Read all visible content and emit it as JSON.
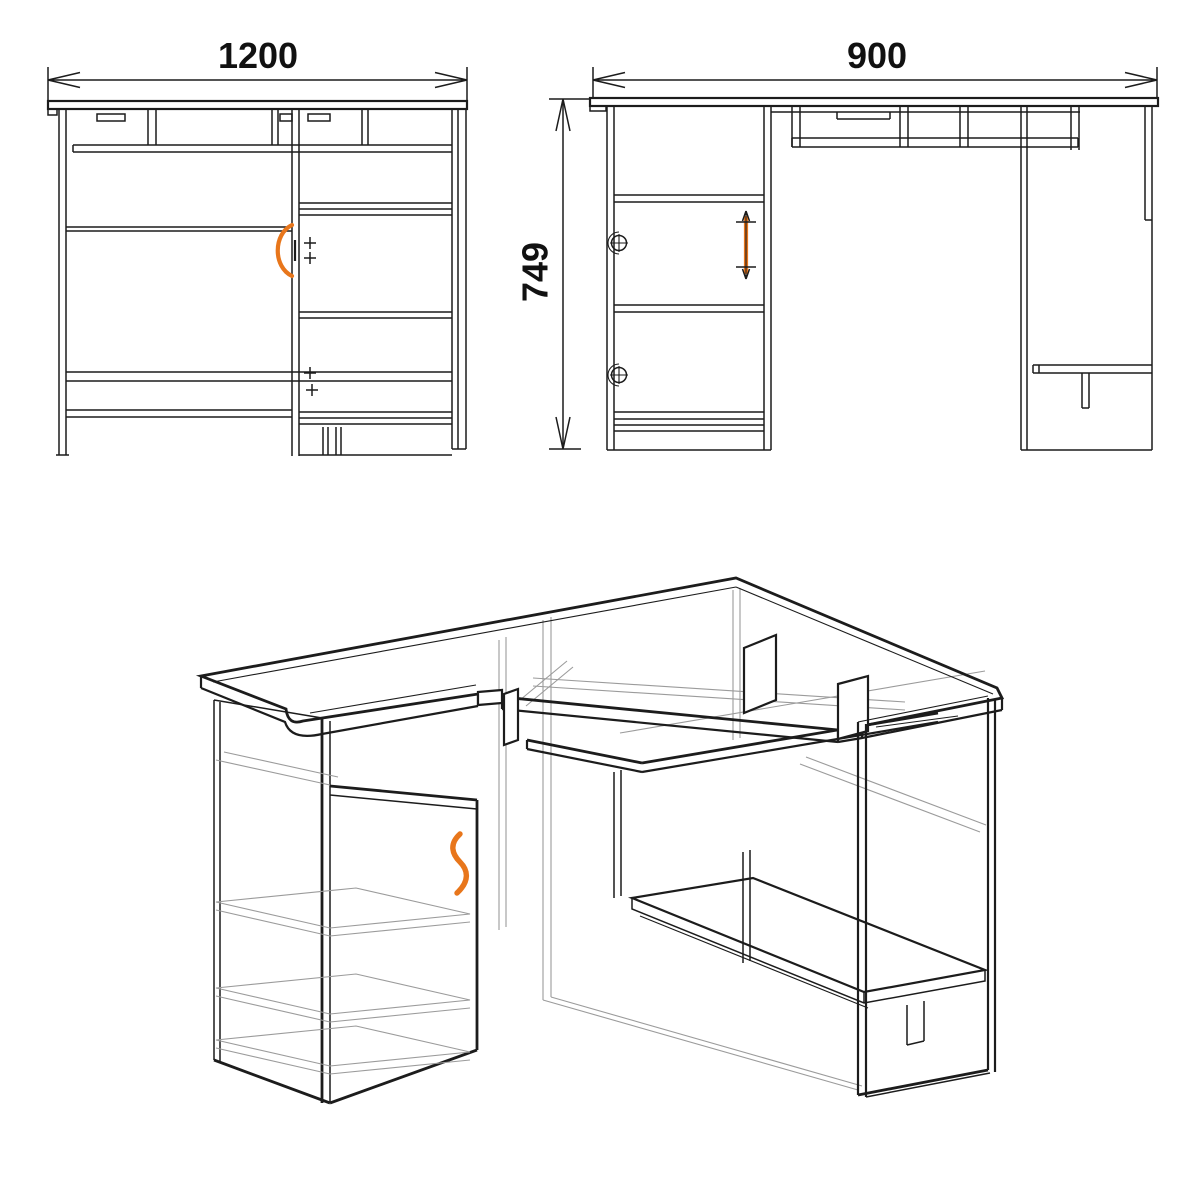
{
  "dimensions": {
    "front_width": "1200",
    "side_depth": "900",
    "height": "749"
  },
  "colors": {
    "line": "#1c1c1c",
    "hidden_line": "#9b9b9b",
    "handle_accent": "#e8761b",
    "background": "#ffffff"
  }
}
